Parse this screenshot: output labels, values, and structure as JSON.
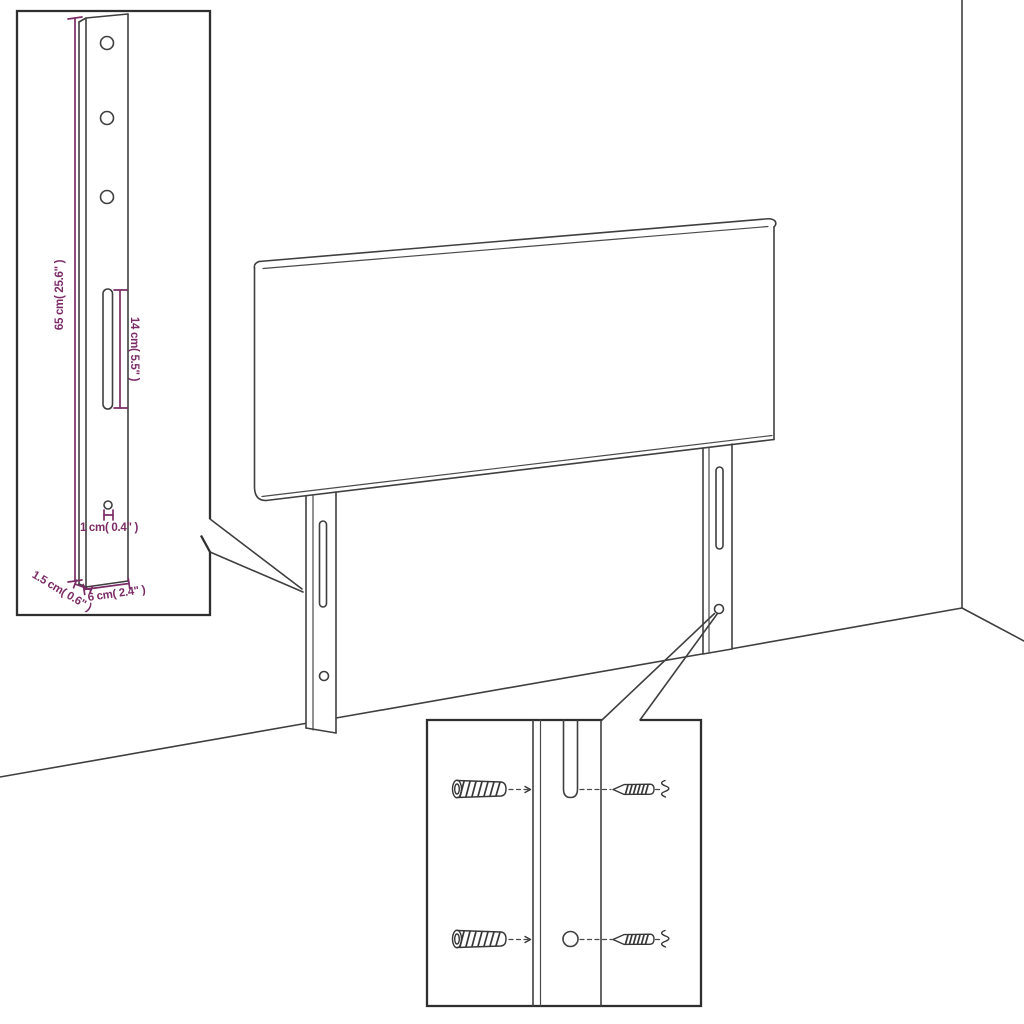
{
  "drawing": {
    "kind": "headboard-assembly-dimension-diagram",
    "dimension_labels": {
      "leg_height": "65 cm( 25.6\" )",
      "slot_length": "14 cm( 5.5\" )",
      "hole_offset": "1 cm( 0.4\" )",
      "leg_thickness": "1.5 cm( 0.6\" )",
      "leg_width": "6 cm( 2.4\" )"
    },
    "colors": {
      "dimension_color": "#7b2c67",
      "line_color": "#3f3f3f",
      "background": "#ffffff"
    }
  }
}
